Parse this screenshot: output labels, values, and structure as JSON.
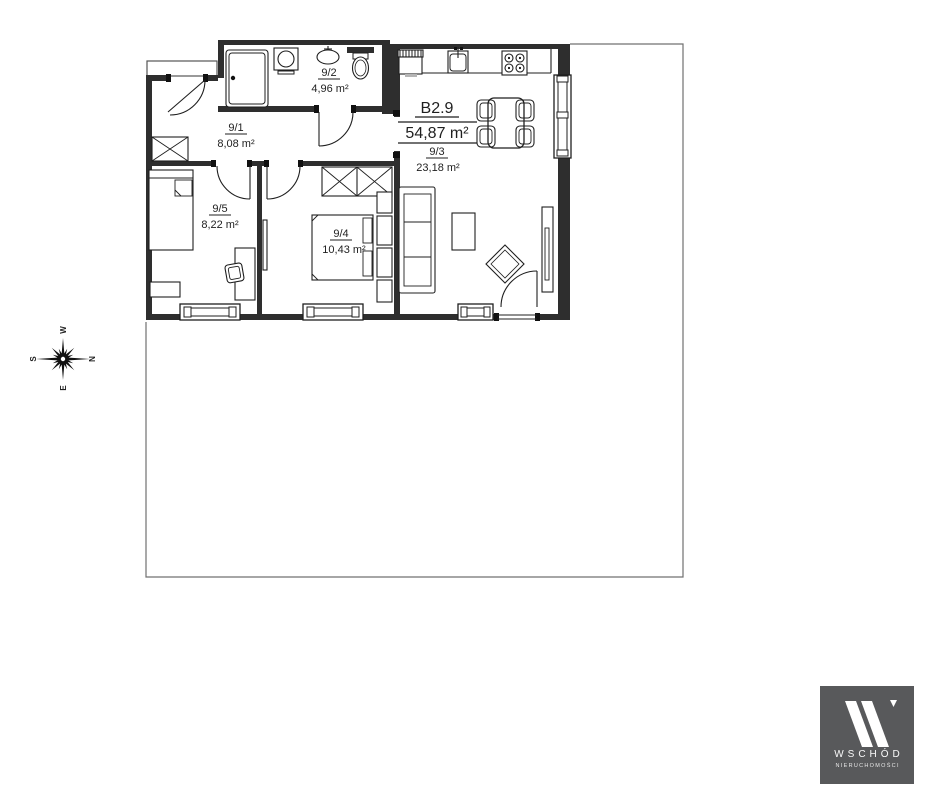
{
  "plan": {
    "unit": {
      "code": "B2.9",
      "area": "54,87 m²"
    },
    "rooms": [
      {
        "number": "9/1",
        "area": "8,08 m²"
      },
      {
        "number": "9/2",
        "area": "4,96 m²"
      },
      {
        "number": "9/3",
        "area": "23,18 m²"
      },
      {
        "number": "9/4",
        "area": "10,43 m²"
      },
      {
        "number": "9/5",
        "area": "8,22 m²"
      }
    ],
    "ink_color": "#1f1f1f",
    "wall_color": "#2e2e2e",
    "boundary_color": "#707070"
  },
  "compass": {
    "north": "N",
    "south": "S",
    "east": "E",
    "west": "W"
  },
  "logo": {
    "name": "WSCHÓD",
    "subtitle": "NIERUCHOMOŚCI",
    "bg_color": "#58595b",
    "text_color": "#fafafa"
  }
}
